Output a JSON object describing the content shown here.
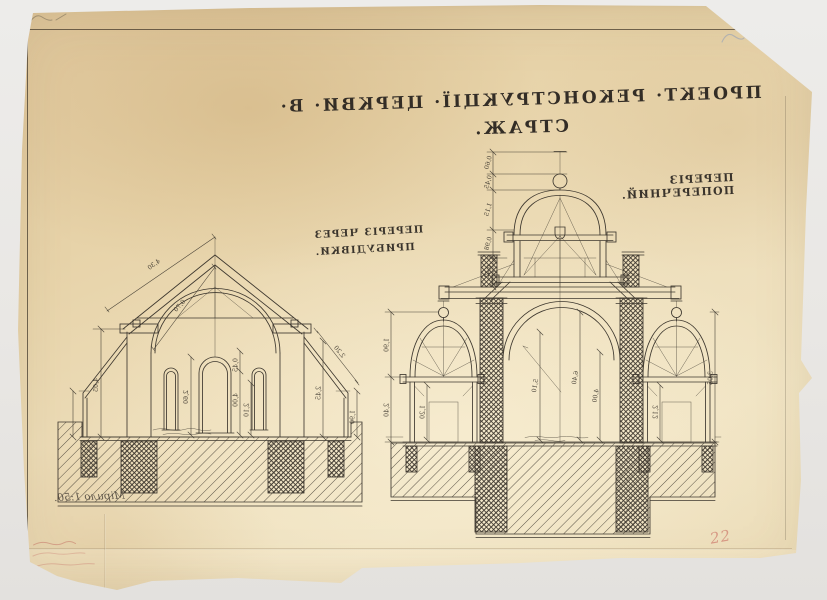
{
  "surface": {
    "background_color": "#eae8e5",
    "paper_color": "#ead7ae",
    "ink_color": "#3e382f",
    "red_mark_color": "#c9766a",
    "blue_mark_color": "#8a9cc0"
  },
  "title": {
    "text": "ПРОЕКТ· РЕКОНСТРУКЦІЇ· ЦЕРКВИ· В· СТРАЖ.",
    "mirrored": true
  },
  "section_labels": {
    "left_line1": "ПЕРЕРІЗ ЧЕРЕЗ",
    "left_line2": "ПРИБУДІВКИ.",
    "right": "ПЕРЕРІЗ ПОПЕРЕЧНИЙ."
  },
  "notes": {
    "scale": "Мірило 1:50.",
    "page_number": "22"
  },
  "dimensions": {
    "left_section": [
      "4,30",
      "0,70",
      "4,05",
      "2,60",
      "0,45",
      "4,00",
      "2,10",
      "2,45",
      "1,90",
      "2,20"
    ],
    "right_section_top": [
      "0,60",
      "0,45",
      "1,15",
      "0,98",
      "0,42"
    ],
    "right_section_left": [
      "1,90",
      "2,40",
      "1,20"
    ],
    "right_section_nave": [
      "5,10",
      "6,40",
      "4,00"
    ],
    "right_section_right": [
      "2,12",
      "3,05"
    ]
  }
}
